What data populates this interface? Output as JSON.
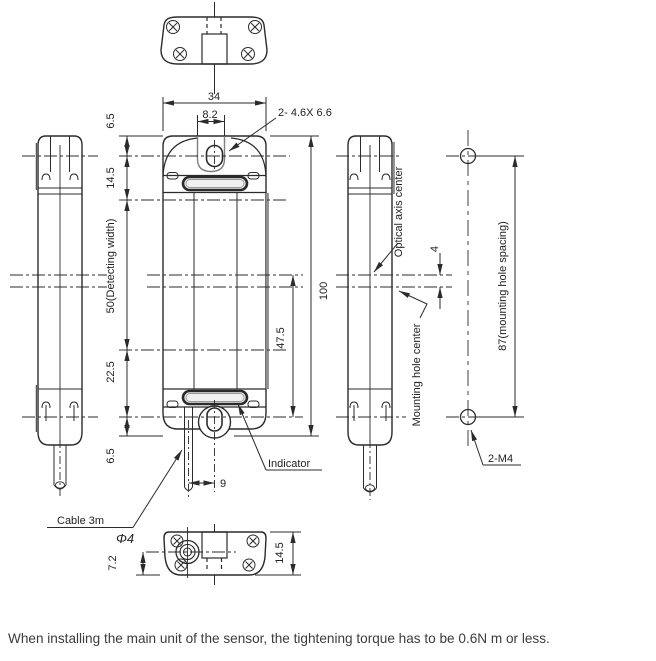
{
  "caption": "When installing the main unit of the sensor, the tightening torque has to be 0.6N m or less.",
  "front_view": {
    "width": "34",
    "slot_width": "8.2",
    "hole_note": "2- 4.6X 6.6",
    "dims_left": [
      "6.5",
      "14.5",
      "50(Detecting width)",
      "22.5",
      "6.5"
    ],
    "height": "100",
    "axis_to_hole": "47.5",
    "cable_offset": "9",
    "indicator_label": "Indicator"
  },
  "side_view": {
    "optical_axis_label": "Optical axis center",
    "axis_offset": "4",
    "mounting_hole_label": "Mounting hole center"
  },
  "mounting_pattern": {
    "hole_spacing": "87(mounting hole spacing)",
    "hole_note": "2-M4"
  },
  "bottom_view": {
    "cable_center_depth": "7.2",
    "depth": "14.5"
  },
  "cable": {
    "label": "Cable 3m",
    "diameter": "Φ4"
  },
  "colors": {
    "line": "#2b2b2b",
    "shade": "#8f8f8f"
  }
}
